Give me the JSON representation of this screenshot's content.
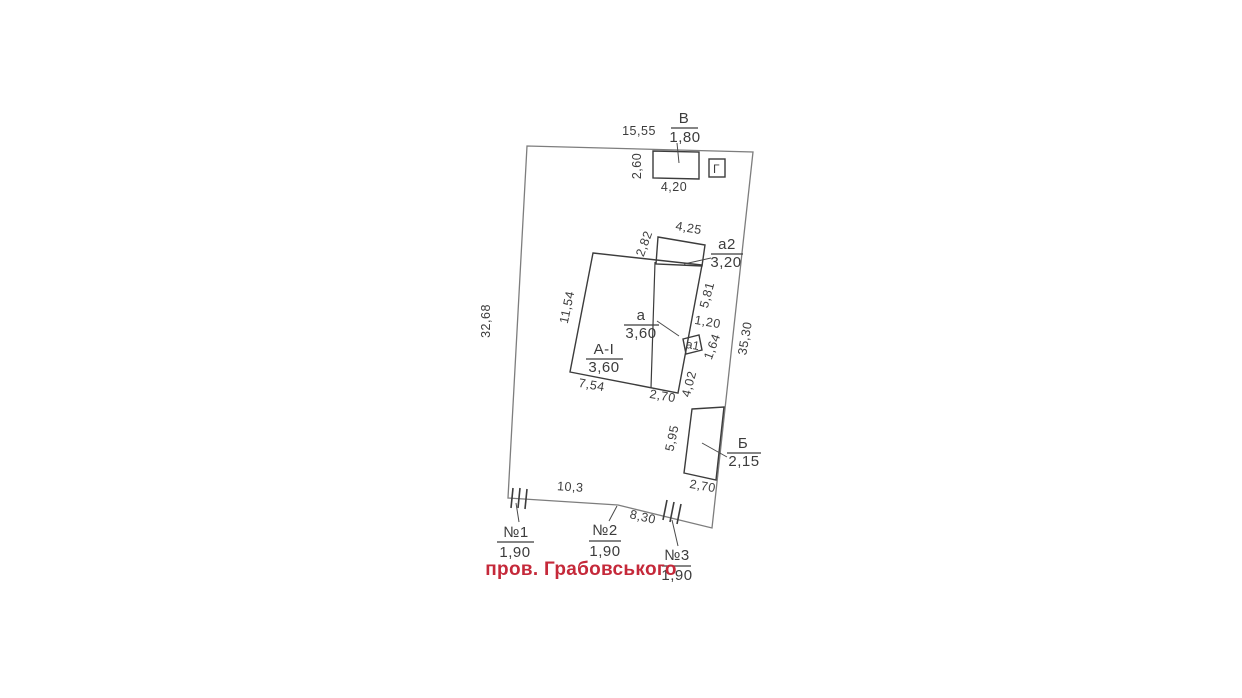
{
  "plan": {
    "street": {
      "name": "пров. Грабовського"
    },
    "colors": {
      "street_text": "#c5293a",
      "building_line": "#3c3c3c",
      "boundary_line": "#7d7d7d",
      "dimension_text": "#3c3c3c",
      "background": "#ffffff"
    },
    "buildings": {
      "v": {
        "letter": "В",
        "height": "1,80"
      },
      "g": {
        "letter": "Г"
      },
      "a2": {
        "letter": "а2",
        "height": "3,20"
      },
      "main": {
        "letter": "А-І",
        "height": "3,60"
      },
      "a": {
        "letter": "а",
        "height": "3,60"
      },
      "a1": {
        "letter": "а1"
      },
      "b": {
        "letter": "Б",
        "height": "2,15"
      }
    },
    "gates": {
      "g1": {
        "label": "№1",
        "width": "1,90"
      },
      "g2": {
        "label": "№2",
        "width": "1,90"
      },
      "g3": {
        "label": "№3",
        "width": "1,90"
      }
    },
    "dims": {
      "plot_top": "15,55",
      "plot_left": "32,68",
      "plot_right": "35,30",
      "frontage_left": "10,3",
      "frontage_right": "8,30",
      "v_width": "4,20",
      "v_depth": "2,60",
      "a2_top": "4,25",
      "a2_left": "2,82",
      "main_left": "11,54",
      "main_bottom_left": "7,54",
      "main_bottom_right": "2,70",
      "main_right_upper": "5,81",
      "porch_depth": "1,20",
      "porch_side": "1,64",
      "main_right_lower": "4,02",
      "b_left": "5,95",
      "b_bottom": "2,70"
    }
  }
}
